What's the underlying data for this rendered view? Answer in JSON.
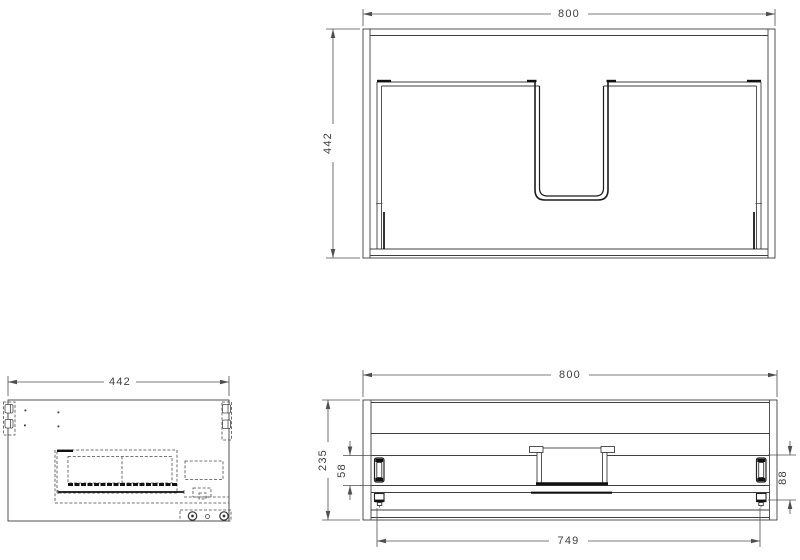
{
  "drawing": {
    "type": "technical-cad-drawing",
    "subject": "wall-hung vanity cabinet with u-shaped sink cutout and internal drawer",
    "units": "mm",
    "colors": {
      "background": "#ffffff",
      "line": "#3f3f3f",
      "heavy_line": "#111111",
      "text": "#3d3d3d"
    }
  },
  "views": {
    "cabinet_front": {
      "name": "cabinet front view",
      "dim_width": "800",
      "dim_height": "442"
    },
    "cabinet_side": {
      "name": "cabinet side section view",
      "dim_depth": "442"
    },
    "drawer_front": {
      "name": "drawer unit front view",
      "dim_width": "800",
      "dim_height": "235",
      "dim_slide_top": "58",
      "dim_slide_right": "88",
      "dim_inner_width": "749"
    }
  }
}
